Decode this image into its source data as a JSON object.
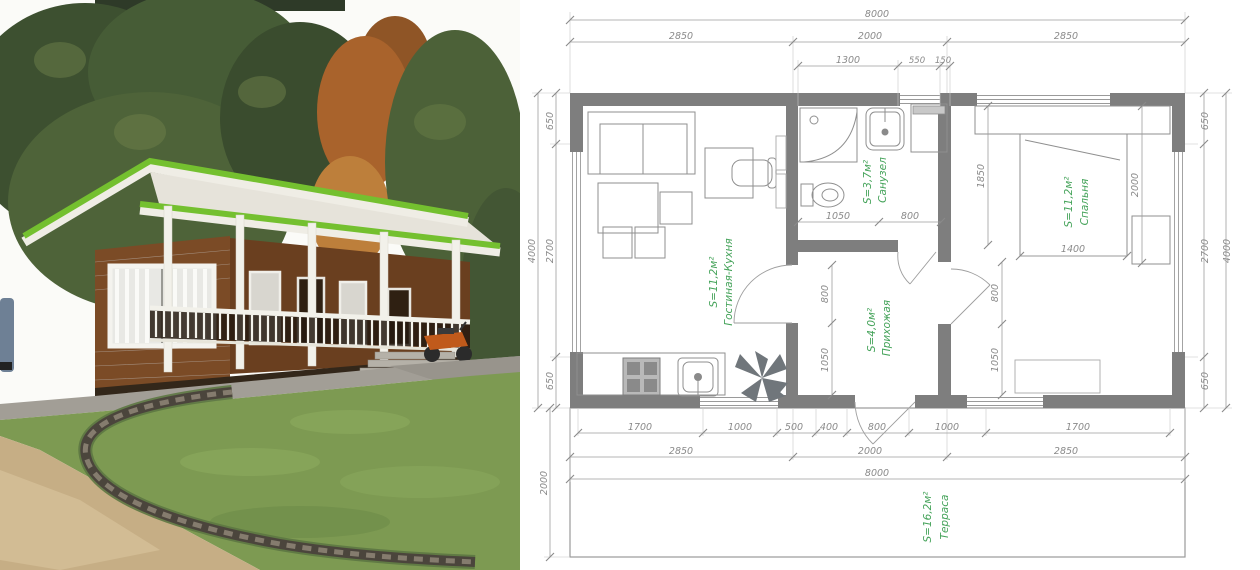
{
  "photo": {
    "description": "Exterior render of a small wooden house with bright green roof trim, white porch posts and railing, lawn, curved stone edging and a parked motorbike",
    "colors": {
      "roof_trim_green": "#74c02f",
      "wood_wall": "#7b4b26",
      "lawn": "#7d9a52",
      "sand": "#c6ae85",
      "stone": "#4b453c"
    }
  },
  "plan": {
    "colors": {
      "wall_fill": "#7e7e7e",
      "dim_text": "#8a8a8a",
      "room_label_green": "#45a35a"
    },
    "top": {
      "total": "8000",
      "sections": [
        "2850",
        "2000",
        "2850"
      ],
      "details": [
        "1300",
        "550",
        "150"
      ]
    },
    "left": {
      "overall": "4000",
      "segments": [
        "650",
        "2700",
        "650"
      ],
      "terrace_depth": "2000"
    },
    "right": {
      "overall": "4000",
      "segments": [
        "650",
        "2700",
        "650"
      ]
    },
    "bottom": {
      "segments": [
        "1700",
        "1000",
        "500",
        "400",
        "800",
        "1000",
        "1700"
      ],
      "sections": [
        "2850",
        "2000",
        "2850"
      ],
      "total": "8000"
    },
    "inner": {
      "bath": [
        "1050",
        "800"
      ],
      "hall_left": [
        "800",
        "1050"
      ],
      "hall_right": [
        "800",
        "1050"
      ],
      "bed": [
        "1850",
        "2000",
        "1400"
      ]
    },
    "rooms": {
      "living": {
        "name": "Гостиная-Кухня",
        "area": "S=11,2м²"
      },
      "bath": {
        "name": "Санузел",
        "area": "S=3,7м²"
      },
      "bedroom": {
        "name": "Спальня",
        "area": "S=11,2м²"
      },
      "hall": {
        "name": "Прихожая",
        "area": "S=4,0м²"
      },
      "terrace": {
        "name": "Терраса",
        "area": "S=16,2м²"
      }
    }
  }
}
